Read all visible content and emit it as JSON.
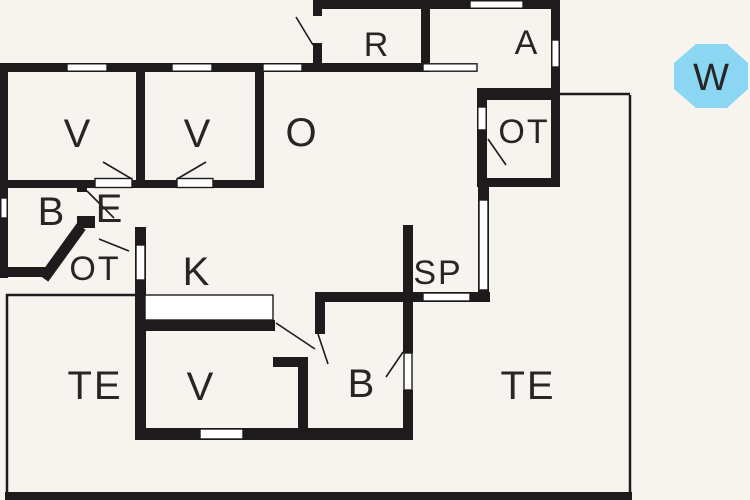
{
  "plan": {
    "type": "floor-plan",
    "rooms": [
      {
        "id": "v-room-1",
        "label": "V"
      },
      {
        "id": "v-room-2",
        "label": "V"
      },
      {
        "id": "o-room",
        "label": "O"
      },
      {
        "id": "r-room",
        "label": "R"
      },
      {
        "id": "a-room",
        "label": "A"
      },
      {
        "id": "ot-room-right",
        "label": "OT"
      },
      {
        "id": "b-room-top",
        "label": "B"
      },
      {
        "id": "e-room",
        "label": "E"
      },
      {
        "id": "ot-room-left",
        "label": "OT"
      },
      {
        "id": "k-room",
        "label": "K"
      },
      {
        "id": "sp-room",
        "label": "SP"
      },
      {
        "id": "terrace-left",
        "label": "TE"
      },
      {
        "id": "v-room-bottom",
        "label": "V"
      },
      {
        "id": "b-room-bottom",
        "label": "B"
      },
      {
        "id": "terrace-right",
        "label": "TE"
      }
    ],
    "compass": {
      "label": "W",
      "fill": "#8bd6f2",
      "text_color": "#2b2b2b"
    },
    "palette": {
      "background": "#f7f4f0",
      "wall": "#1d1b1b",
      "window_fill": "#ffffff",
      "label": "#262626"
    }
  }
}
